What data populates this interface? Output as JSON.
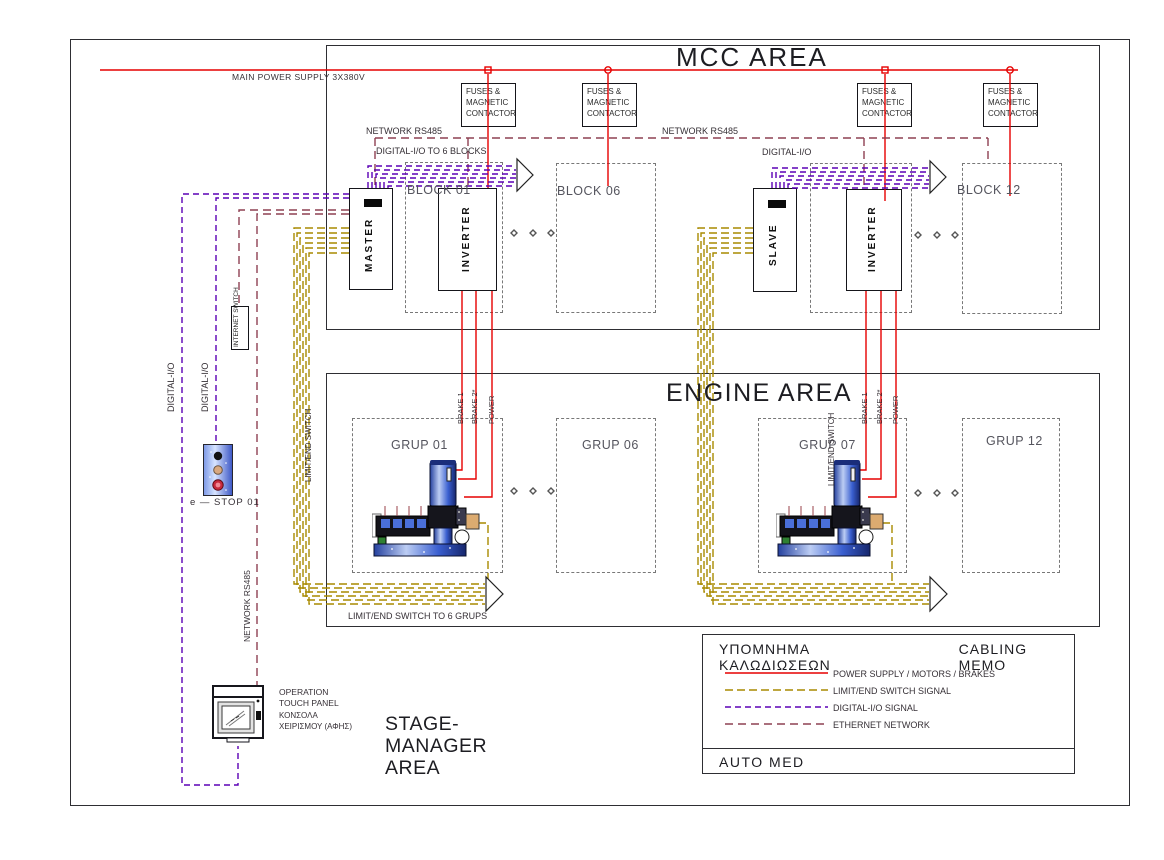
{
  "labels": {
    "main_power": "MAIN POWER SUPPLY 3X380V",
    "mcc_area": "MCC AREA",
    "engine_area": "ENGINE AREA",
    "stage_area": "STAGE-\nMANAGER\nAREA",
    "fuses": "FUSES &\nMAGNETIC\nCONTACTOR",
    "network_rs485": "NETWORK RS485",
    "digital_io_blocks": "DIGITAL-I/O TO 6 BLOCKS",
    "digital_io": "DIGITAL-I/O",
    "block01": "BLOCK 01",
    "block06": "BLOCK 06",
    "block12": "BLOCK 12",
    "master": "MASTER",
    "slave": "SLAVE",
    "inverter": "INVERTER",
    "brake1": "BRAKE 1",
    "brake2": "BRAKE 2*",
    "power": "POWER",
    "grup01": "GRUP 01",
    "grup06": "GRUP 06",
    "grup07": "GRUP 07",
    "grup12": "GRUP 12",
    "limit_end_switch": "LIMIT/END SWITCH",
    "limit_to_grups": "LIMIT/END SWITCH TO 6 GRUPS",
    "internet_switch": "INTERNET\nSWITCH",
    "estop": "e — STOP 01",
    "operation_panel": "OPERATION\nTOUCH PANEL",
    "console_greek": "ΚΟΝΣΟΛΑ\nΧΕΙΡΙΣΜΟΥ (ΑΦΗΣ)"
  },
  "legend": {
    "title_greek": "ΥΠΟΜΝΗΜΑ ΚΑΛΩΔΙΩΣΕΩΝ",
    "title_en": "CABLING MEMO",
    "entries": [
      {
        "label": "POWER SUPPLY / MOTORS / BRAKES",
        "style": "solid",
        "color_key": "power"
      },
      {
        "label": "LIMIT/END SWITCH  SIGNAL",
        "style": "dashed",
        "color_key": "limit"
      },
      {
        "label": "DIGITAL-I/O  SIGNAL",
        "style": "dashed",
        "color_key": "digital"
      },
      {
        "label": "ETHERNET  NETWORK",
        "style": "dashed",
        "color_key": "ethernet"
      }
    ],
    "footer": "AUTO MED"
  },
  "colors": {
    "power": "#e60000",
    "limit": "#a88a00",
    "digital": "#5b00b5",
    "ethernet": "#8e4052"
  }
}
